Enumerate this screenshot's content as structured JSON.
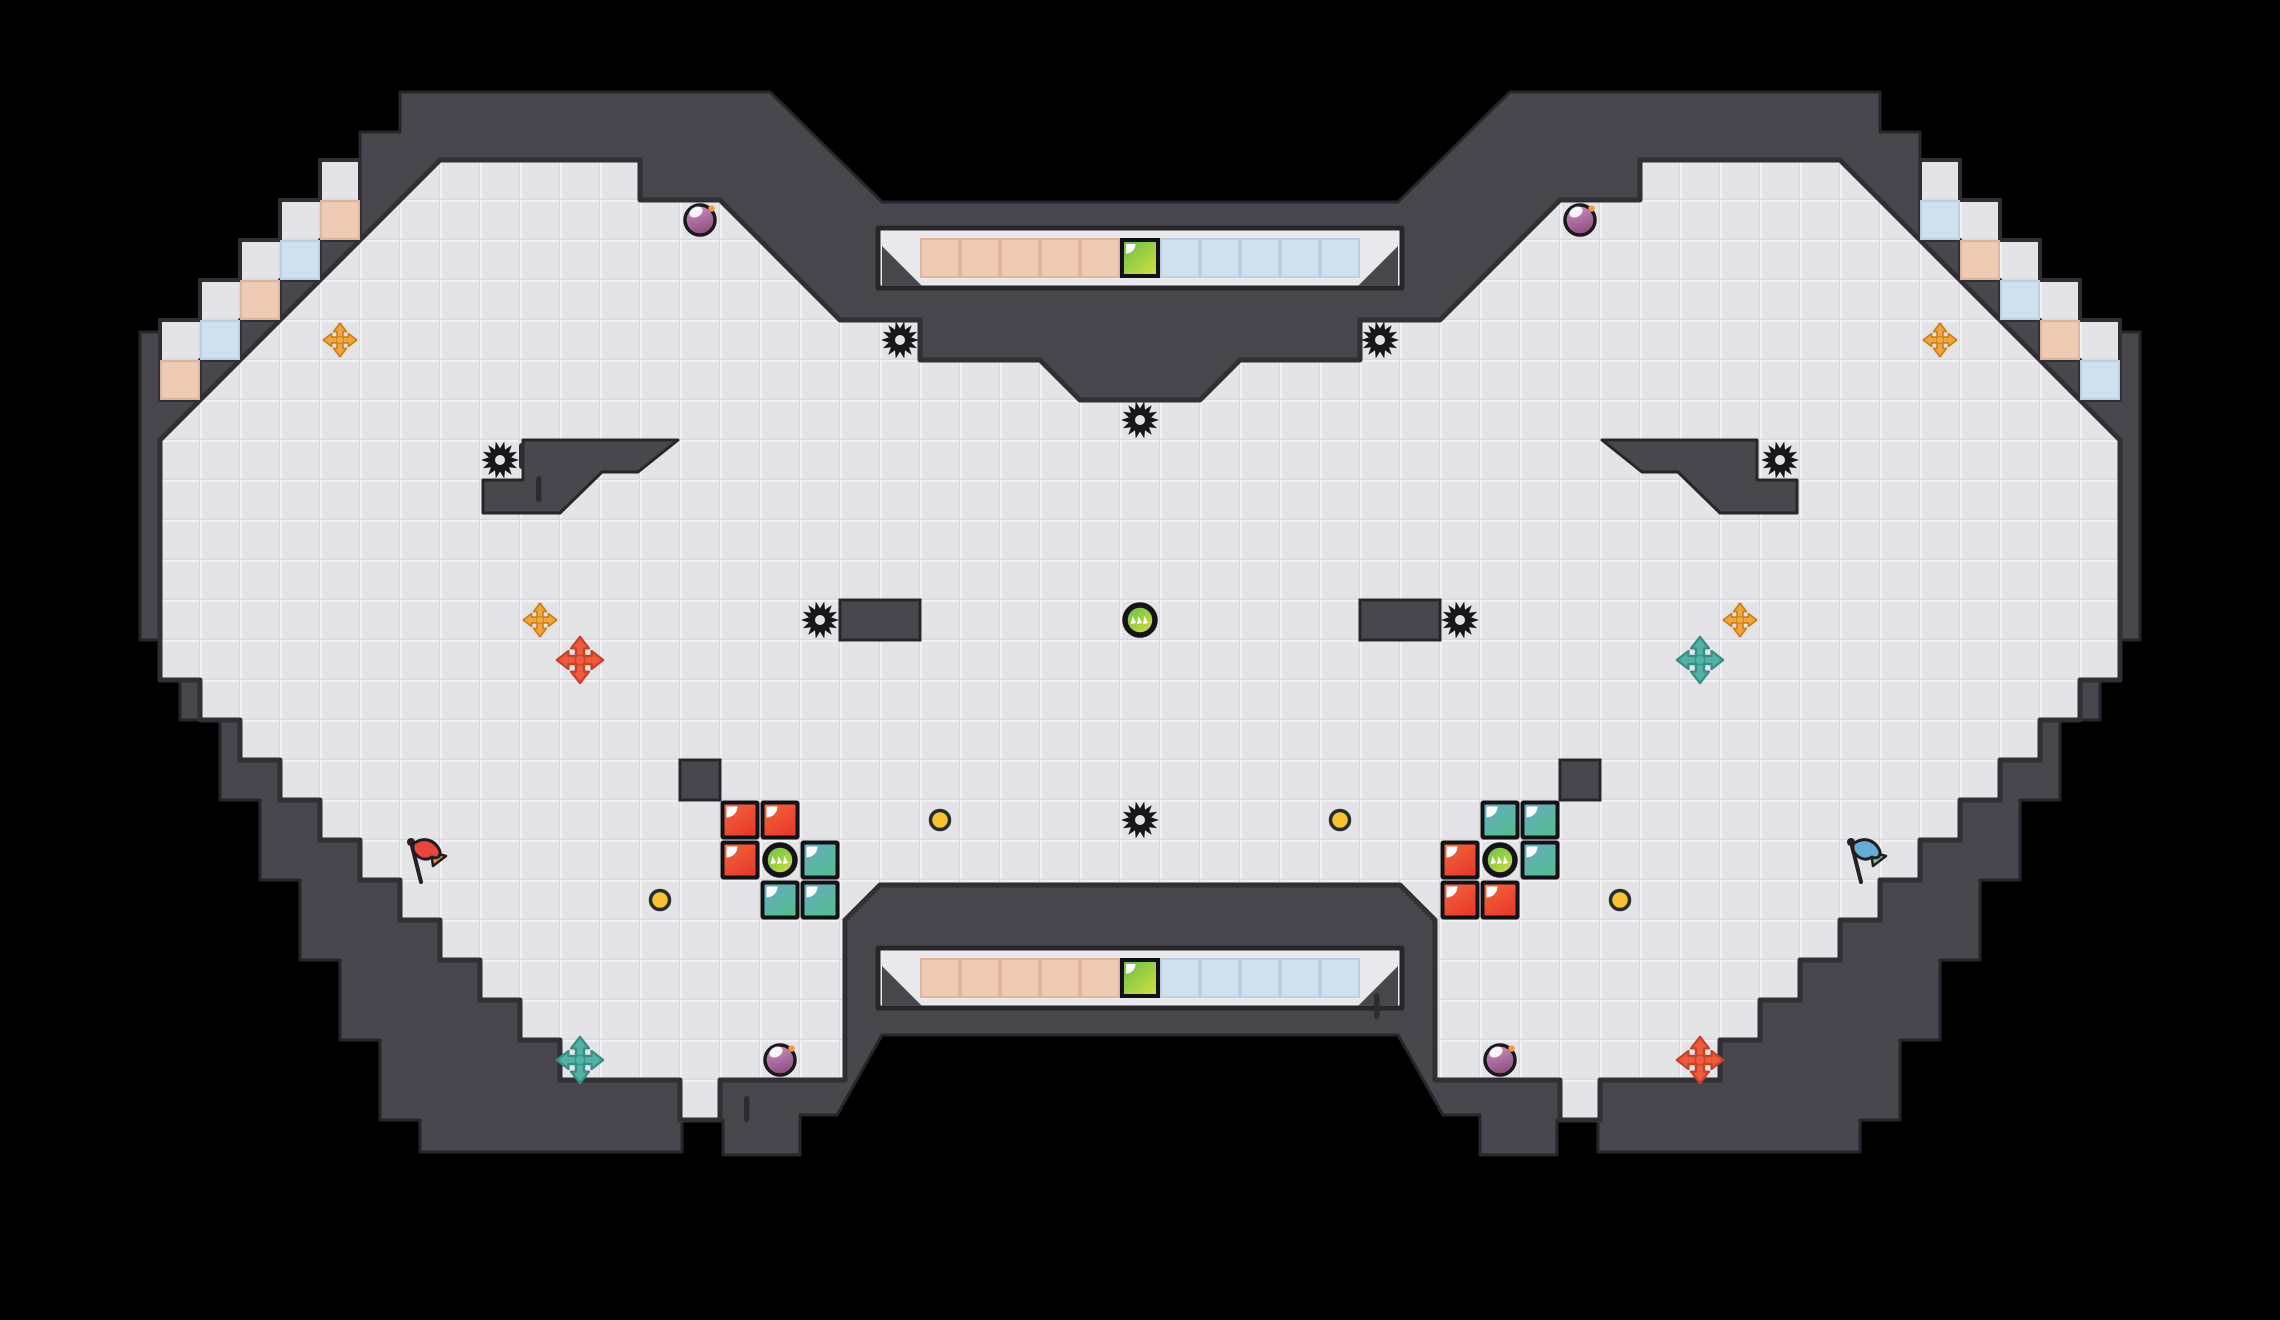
{
  "palette": {
    "bg": "#000000",
    "wall": "#47474d",
    "wall_edge": "#26262b",
    "floor": "#e4e4e7",
    "floor_line": "#f1f1f4",
    "floor_shade": "#d9d9dd",
    "boundary": "#2f2f35",
    "tick": "#2c2c31",
    "slot_bg": "#e9e9ec",
    "slot_edge": "#26262b",
    "tile_peach": "#eecab5",
    "tile_peach_edge": "#e0b49c",
    "tile_blue": "#cfe1ee",
    "tile_blue_edge": "#b9cfe2",
    "block_red_a": "#f6693e",
    "block_red_b": "#e63a2a",
    "block_teal_a": "#68aacb",
    "block_teal_b": "#55bd8e",
    "green_a": "#64bd4a",
    "green_b": "#cedd40",
    "bomb_a": "#cf92c4",
    "bomb_b": "#8c4f80",
    "bomb_fuse": "#f49b33",
    "coin": "#f6c331",
    "coin_edge": "#2a2a30",
    "gold": "#f2a636",
    "gold_dark": "#c97f22",
    "cross_red": "#ee5a3a",
    "cross_red_dark": "#c4432a",
    "cross_teal": "#52b0a4",
    "cross_teal_dark": "#3a8d85",
    "flag_red": "#e8463c",
    "flag_orange": "#f0913c",
    "flag_blue": "#64aed3",
    "flag_green": "#7fcb96",
    "pole": "#222227",
    "saw": "#17171a",
    "ink": "#121216",
    "white": "#ffffff"
  },
  "level": {
    "canvas": {
      "w": 2280,
      "h": 1320
    },
    "cell": 40,
    "silhouette": [
      [
        1140,
        202
      ],
      [
        1398,
        202
      ],
      [
        1510,
        92
      ],
      [
        1840,
        92
      ],
      [
        1880,
        92
      ],
      [
        1880,
        132
      ],
      [
        1920,
        132
      ],
      [
        1920,
        172
      ],
      [
        1960,
        172
      ],
      [
        1960,
        212
      ],
      [
        2000,
        212
      ],
      [
        2000,
        252
      ],
      [
        2040,
        252
      ],
      [
        2040,
        292
      ],
      [
        2080,
        292
      ],
      [
        2080,
        332
      ],
      [
        2140,
        332
      ],
      [
        2140,
        640
      ],
      [
        2100,
        640
      ],
      [
        2100,
        720
      ],
      [
        2060,
        720
      ],
      [
        2060,
        800
      ],
      [
        2020,
        800
      ],
      [
        2020,
        880
      ],
      [
        1980,
        880
      ],
      [
        1980,
        960
      ],
      [
        1940,
        960
      ],
      [
        1940,
        1040
      ],
      [
        1900,
        1040
      ],
      [
        1900,
        1120
      ],
      [
        1860,
        1120
      ],
      [
        1860,
        1152
      ],
      [
        1598,
        1152
      ],
      [
        1598,
        1120
      ],
      [
        1557,
        1120
      ],
      [
        1557,
        1155
      ],
      [
        1480,
        1155
      ],
      [
        1480,
        1115
      ],
      [
        1443,
        1115
      ],
      [
        1398,
        1035
      ],
      [
        882,
        1035
      ],
      [
        837,
        1115
      ],
      [
        800,
        1115
      ],
      [
        800,
        1155
      ],
      [
        723,
        1155
      ],
      [
        723,
        1120
      ],
      [
        682,
        1120
      ],
      [
        682,
        1152
      ],
      [
        420,
        1152
      ],
      [
        420,
        1120
      ],
      [
        380,
        1120
      ],
      [
        380,
        1040
      ],
      [
        340,
        1040
      ],
      [
        340,
        960
      ],
      [
        300,
        960
      ],
      [
        300,
        880
      ],
      [
        260,
        880
      ],
      [
        260,
        800
      ],
      [
        220,
        800
      ],
      [
        220,
        720
      ],
      [
        180,
        720
      ],
      [
        180,
        640
      ],
      [
        140,
        640
      ],
      [
        140,
        332
      ],
      [
        200,
        332
      ],
      [
        200,
        292
      ],
      [
        240,
        292
      ],
      [
        240,
        252
      ],
      [
        280,
        252
      ],
      [
        280,
        212
      ],
      [
        320,
        212
      ],
      [
        320,
        172
      ],
      [
        360,
        172
      ],
      [
        360,
        132
      ],
      [
        400,
        132
      ],
      [
        400,
        92
      ],
      [
        440,
        92
      ],
      [
        770,
        92
      ],
      [
        882,
        202
      ]
    ],
    "floor": [
      [
        440,
        160
      ],
      [
        640,
        160
      ],
      [
        640,
        200
      ],
      [
        720,
        200
      ],
      [
        840,
        320
      ],
      [
        920,
        320
      ],
      [
        920,
        360
      ],
      [
        1040,
        360
      ],
      [
        1080,
        400
      ],
      [
        1200,
        400
      ],
      [
        1240,
        360
      ],
      [
        1360,
        360
      ],
      [
        1360,
        320
      ],
      [
        1440,
        320
      ],
      [
        1560,
        200
      ],
      [
        1640,
        200
      ],
      [
        1640,
        160
      ],
      [
        1840,
        160
      ],
      [
        2120,
        440
      ],
      [
        2120,
        680
      ],
      [
        2080,
        680
      ],
      [
        2080,
        720
      ],
      [
        2040,
        720
      ],
      [
        2040,
        760
      ],
      [
        2000,
        760
      ],
      [
        2000,
        800
      ],
      [
        1960,
        800
      ],
      [
        1960,
        840
      ],
      [
        1920,
        840
      ],
      [
        1920,
        880
      ],
      [
        1880,
        880
      ],
      [
        1880,
        920
      ],
      [
        1840,
        920
      ],
      [
        1840,
        960
      ],
      [
        1800,
        960
      ],
      [
        1800,
        1000
      ],
      [
        1760,
        1000
      ],
      [
        1760,
        1040
      ],
      [
        1720,
        1040
      ],
      [
        1720,
        1080
      ],
      [
        1600,
        1080
      ],
      [
        1600,
        1120
      ],
      [
        1560,
        1120
      ],
      [
        1560,
        1080
      ],
      [
        1435,
        1080
      ],
      [
        1435,
        920
      ],
      [
        1400,
        885
      ],
      [
        880,
        885
      ],
      [
        845,
        920
      ],
      [
        845,
        1080
      ],
      [
        720,
        1080
      ],
      [
        720,
        1120
      ],
      [
        680,
        1120
      ],
      [
        680,
        1080
      ],
      [
        560,
        1080
      ],
      [
        560,
        1040
      ],
      [
        520,
        1040
      ],
      [
        520,
        1000
      ],
      [
        480,
        1000
      ],
      [
        480,
        960
      ],
      [
        440,
        960
      ],
      [
        440,
        920
      ],
      [
        400,
        920
      ],
      [
        400,
        880
      ],
      [
        360,
        880
      ],
      [
        360,
        840
      ],
      [
        320,
        840
      ],
      [
        320,
        800
      ],
      [
        280,
        800
      ],
      [
        280,
        760
      ],
      [
        240,
        760
      ],
      [
        240,
        720
      ],
      [
        200,
        720
      ],
      [
        200,
        680
      ],
      [
        160,
        680
      ],
      [
        160,
        440
      ]
    ],
    "channel_left": [
      [
        160,
        320
      ],
      [
        200,
        320
      ],
      [
        200,
        280
      ],
      [
        240,
        280
      ],
      [
        240,
        240
      ],
      [
        280,
        240
      ],
      [
        280,
        200
      ],
      [
        320,
        200
      ],
      [
        320,
        160
      ],
      [
        360,
        160
      ],
      [
        360,
        240
      ],
      [
        320,
        240
      ],
      [
        320,
        280
      ],
      [
        280,
        280
      ],
      [
        280,
        320
      ],
      [
        240,
        320
      ],
      [
        240,
        360
      ],
      [
        200,
        360
      ],
      [
        200,
        400
      ],
      [
        160,
        400
      ]
    ],
    "channel_right": [
      [
        2120,
        320
      ],
      [
        2080,
        320
      ],
      [
        2080,
        280
      ],
      [
        2040,
        280
      ],
      [
        2040,
        240
      ],
      [
        2000,
        240
      ],
      [
        2000,
        200
      ],
      [
        1960,
        200
      ],
      [
        1960,
        160
      ],
      [
        1920,
        160
      ],
      [
        1920,
        240
      ],
      [
        1960,
        240
      ],
      [
        1960,
        280
      ],
      [
        2000,
        280
      ],
      [
        2000,
        320
      ],
      [
        2040,
        320
      ],
      [
        2040,
        360
      ],
      [
        2080,
        360
      ],
      [
        2080,
        400
      ],
      [
        2120,
        400
      ]
    ],
    "interior_polys": [
      {
        "name": "wall-ledge-left",
        "points": [
          [
            678,
            440
          ],
          [
            523,
            440
          ],
          [
            523,
            480
          ],
          [
            483,
            480
          ],
          [
            483,
            513
          ],
          [
            560,
            513
          ],
          [
            602,
            472
          ],
          [
            638,
            472
          ]
        ]
      },
      {
        "name": "wall-ledge-right",
        "points": [
          [
            1602,
            440
          ],
          [
            1757,
            440
          ],
          [
            1757,
            480
          ],
          [
            1797,
            480
          ],
          [
            1797,
            513
          ],
          [
            1720,
            513
          ],
          [
            1678,
            472
          ],
          [
            1642,
            472
          ]
        ]
      }
    ],
    "interior_rects": [
      {
        "name": "wall-platform-left",
        "x": 840,
        "y": 600,
        "w": 80,
        "h": 40
      },
      {
        "name": "wall-platform-right",
        "x": 1360,
        "y": 600,
        "w": 80,
        "h": 40
      },
      {
        "name": "wall-pillar-left",
        "x": 680,
        "y": 760,
        "w": 40,
        "h": 40
      },
      {
        "name": "wall-pillar-right",
        "x": 1560,
        "y": 760,
        "w": 40,
        "h": 40
      }
    ],
    "slots": [
      {
        "x": 878,
        "y": 228,
        "w": 524,
        "h": 60,
        "tile_y": 238
      },
      {
        "x": 878,
        "y": 948,
        "w": 524,
        "h": 60,
        "tile_y": 958
      }
    ],
    "slot_row": {
      "peach_cols": [
        23,
        27
      ],
      "switch_col": 28,
      "blue_cols": [
        29,
        33
      ]
    },
    "ticks": [
      [
        519,
        443
      ],
      [
        536,
        476
      ],
      [
        1374,
        993
      ],
      [
        744,
        1096
      ]
    ]
  },
  "tiles": {
    "checkers": [
      {
        "col": 8,
        "row": 5,
        "color": "peach"
      },
      {
        "col": 7,
        "row": 6,
        "color": "blue"
      },
      {
        "col": 6,
        "row": 7,
        "color": "peach"
      },
      {
        "col": 5,
        "row": 8,
        "color": "blue"
      },
      {
        "col": 4,
        "row": 9,
        "color": "peach"
      },
      {
        "col": 48,
        "row": 5,
        "color": "blue"
      },
      {
        "col": 49,
        "row": 6,
        "color": "peach"
      },
      {
        "col": 50,
        "row": 7,
        "color": "blue"
      },
      {
        "col": 51,
        "row": 8,
        "color": "peach"
      },
      {
        "col": 52,
        "row": 9,
        "color": "blue"
      }
    ],
    "blocks": [
      {
        "col": 18,
        "row": 20,
        "color": "red"
      },
      {
        "col": 19,
        "row": 20,
        "color": "red"
      },
      {
        "col": 18,
        "row": 21,
        "color": "red"
      },
      {
        "col": 20,
        "row": 21,
        "color": "teal"
      },
      {
        "col": 19,
        "row": 22,
        "color": "teal"
      },
      {
        "col": 20,
        "row": 22,
        "color": "teal"
      },
      {
        "col": 37,
        "row": 20,
        "color": "teal"
      },
      {
        "col": 38,
        "row": 20,
        "color": "teal"
      },
      {
        "col": 38,
        "row": 21,
        "color": "teal"
      },
      {
        "col": 36,
        "row": 21,
        "color": "red"
      },
      {
        "col": 36,
        "row": 22,
        "color": "red"
      },
      {
        "col": 37,
        "row": 22,
        "color": "red"
      }
    ]
  },
  "entities": {
    "saws": [
      [
        900,
        340
      ],
      [
        1380,
        340
      ],
      [
        1140,
        420
      ],
      [
        500,
        460
      ],
      [
        1780,
        460
      ],
      [
        820,
        620
      ],
      [
        1460,
        620
      ],
      [
        1140,
        820
      ]
    ],
    "coins": [
      [
        940,
        820
      ],
      [
        1340,
        820
      ],
      [
        660,
        900
      ],
      [
        1620,
        900
      ]
    ],
    "bombs": [
      [
        700,
        220
      ],
      [
        1580,
        220
      ],
      [
        780,
        1060
      ],
      [
        1500,
        1060
      ]
    ],
    "pads_gold": [
      [
        340,
        340
      ],
      [
        1940,
        340
      ],
      [
        540,
        620
      ],
      [
        1740,
        620
      ]
    ],
    "crosses": [
      {
        "x": 580,
        "y": 660,
        "color": "red"
      },
      {
        "x": 1700,
        "y": 660,
        "color": "teal"
      },
      {
        "x": 580,
        "y": 1060,
        "color": "teal"
      },
      {
        "x": 1700,
        "y": 1060,
        "color": "red"
      }
    ],
    "drones": [
      [
        1140,
        620
      ],
      [
        780,
        860
      ],
      [
        1500,
        860
      ]
    ],
    "flags": [
      {
        "x": 418,
        "y": 868,
        "color": "red"
      },
      {
        "x": 1858,
        "y": 868,
        "color": "blue"
      }
    ]
  }
}
